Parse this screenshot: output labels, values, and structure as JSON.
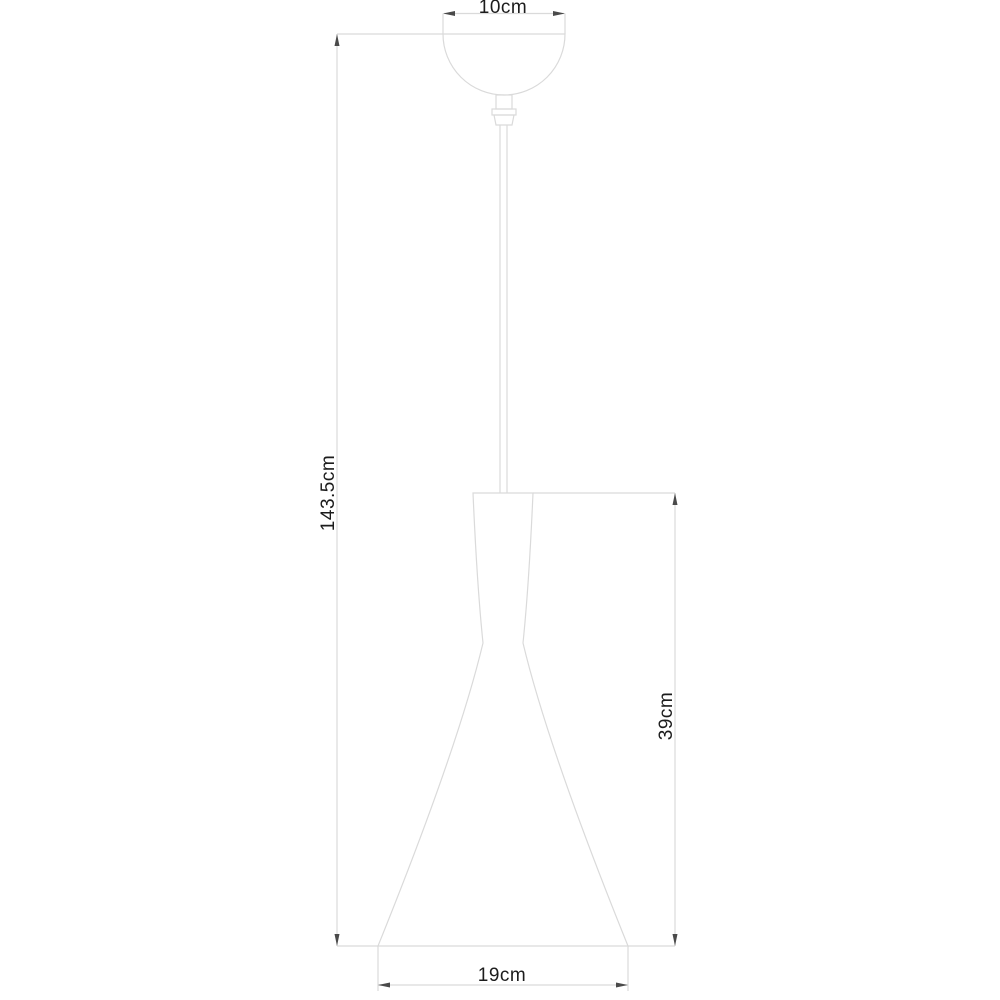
{
  "diagram": {
    "title": "pendant-lamp-dimension-drawing",
    "background": "#ffffff",
    "colors": {
      "outline": "#dadada",
      "dimension_text": "#1c1c1c",
      "arrow": "#4a4a4a"
    },
    "dimensions": {
      "canopy_width": "10cm",
      "overall_height": "143.5cm",
      "shade_height": "39cm",
      "shade_diameter": "19cm"
    }
  }
}
